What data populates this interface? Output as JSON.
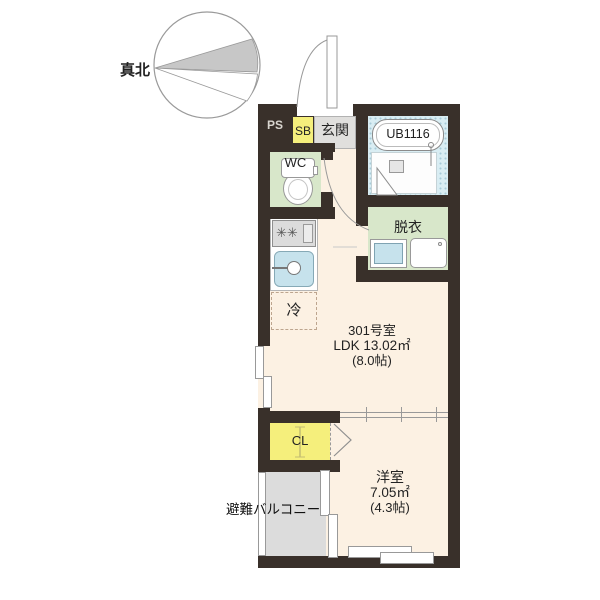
{
  "compass": {
    "label": "真北"
  },
  "rooms": {
    "ps": {
      "label": "PS"
    },
    "sb": {
      "label": "SB"
    },
    "entrance": {
      "label": "玄関"
    },
    "wc": {
      "label": "WC"
    },
    "bath": {
      "label": "UB1116"
    },
    "dressing": {
      "label": "脱衣"
    },
    "fridge": {
      "label": "冷"
    },
    "ldk": {
      "room_no": "301号室",
      "area": "LDK 13.02㎡",
      "tatami": "(8.0帖)"
    },
    "closet": {
      "label": "CL"
    },
    "western": {
      "name": "洋室",
      "area": "7.05㎡",
      "tatami": "(4.3帖)"
    },
    "balcony": {
      "label": "避難バルコニー"
    }
  },
  "colors": {
    "wall": "#39302a",
    "floor": "#fcf1e3",
    "wet_room_green": "#d8e7ca",
    "storage_yellow": "#f5ef7c",
    "bath_blue": "#d9edf3",
    "entrance_gray": "#e0dfdd",
    "balcony_gray": "#dcdcdc",
    "fixture_blue": "#c6e2ec"
  }
}
